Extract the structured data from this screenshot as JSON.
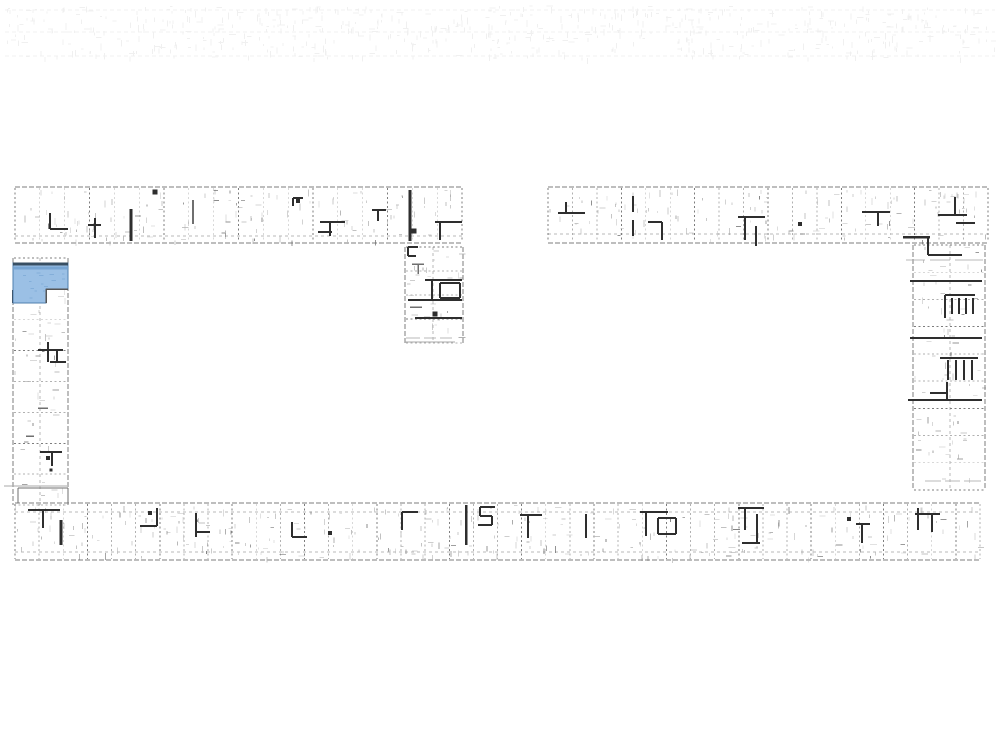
{
  "page": {
    "kind": "architectural-site-floor-plan",
    "background": "#ffffff",
    "description_visible_text": ""
  },
  "floorplan": {
    "canvas": {
      "w": 1000,
      "h": 750,
      "bg": "#ffffff"
    },
    "palette": {
      "dark": "#2e2e2e",
      "mid": "#6f6f6f",
      "light": "#a9a9a9",
      "noise": "#b6b6b6",
      "edge": "#7c7c7c",
      "ghost": "#9a9a9a",
      "highlight_fill": "#9bc0e5",
      "highlight_shade": "#74a3d2",
      "highlight_top_edge": "#384f63",
      "highlight_outline": "#4f7fae",
      "notch_edge": "#555555"
    },
    "ghost_strip": {
      "x": 5,
      "y": 6,
      "w": 990,
      "h": 52,
      "opacity": 0.14,
      "lines_y": [
        10,
        32,
        56
      ],
      "tick_count": 620
    },
    "wings": [
      {
        "id": "wing-top-left",
        "dir": "h",
        "x": 15,
        "y": 187,
        "len": 447,
        "th": 56,
        "units": 18,
        "inner": [
          236
        ]
      },
      {
        "id": "wing-top-right",
        "dir": "h",
        "x": 548,
        "y": 187,
        "len": 440,
        "th": 56,
        "units": 18,
        "inner": [
          234
        ]
      },
      {
        "id": "wing-bottom",
        "dir": "h",
        "x": 15,
        "y": 503,
        "len": 965,
        "th": 57,
        "units": 40,
        "inner": [
          512,
          552
        ]
      },
      {
        "id": "wing-left-column",
        "dir": "v",
        "x": 13,
        "y": 258,
        "len": 247,
        "th": 55,
        "units": 8,
        "inner": [
          40
        ]
      },
      {
        "id": "wing-mid-column",
        "dir": "v",
        "x": 405,
        "y": 247,
        "len": 96,
        "th": 58,
        "units": 4,
        "inner": [
          433
        ]
      },
      {
        "id": "wing-right-column",
        "dir": "v",
        "x": 913,
        "y": 245,
        "len": 245,
        "th": 72,
        "units": 9,
        "inner": [
          950
        ]
      }
    ],
    "fixtures": [
      {
        "segs": [
          [
            50,
            213,
            50,
            229
          ],
          [
            50,
            229,
            68,
            229
          ]
        ],
        "w": 2.2,
        "c": "dark"
      },
      {
        "segs": [
          [
            95,
            218,
            95,
            238
          ],
          [
            88,
            225,
            101,
            225
          ]
        ],
        "w": 1.8,
        "c": "dark"
      },
      {
        "segs": [
          [
            131,
            209,
            131,
            241
          ]
        ],
        "w": 3,
        "c": "dark"
      },
      {
        "segs": [
          [
            193,
            200,
            193,
            224
          ]
        ],
        "w": 1.8,
        "c": "mid"
      },
      {
        "segs": [
          [
            293,
            198,
            303,
            198
          ],
          [
            293,
            198,
            293,
            206
          ]
        ],
        "w": 2,
        "c": "dark"
      },
      {
        "segs": [
          [
            320,
            222,
            345,
            222
          ],
          [
            330,
            222,
            330,
            236
          ],
          [
            318,
            232,
            332,
            232
          ]
        ],
        "w": 2.2,
        "c": "dark"
      },
      {
        "segs": [
          [
            372,
            210,
            386,
            210
          ],
          [
            378,
            210,
            378,
            221
          ]
        ],
        "w": 2,
        "c": "dark"
      },
      {
        "segs": [
          [
            410,
            190,
            410,
            241
          ]
        ],
        "w": 2.8,
        "c": "dark"
      },
      {
        "segs": [
          [
            435,
            222,
            462,
            222
          ],
          [
            440,
            222,
            440,
            240
          ]
        ],
        "w": 2.2,
        "c": "dark"
      },
      {
        "segs": [
          [
            408,
            247,
            418,
            247
          ],
          [
            408,
            247,
            408,
            256
          ],
          [
            408,
            256,
            416,
            256
          ]
        ],
        "w": 2,
        "c": "dark"
      },
      {
        "segs": [
          [
            412,
            264,
            424,
            264
          ],
          [
            418,
            264,
            418,
            274
          ]
        ],
        "w": 1.5,
        "c": "mid"
      },
      {
        "segs": [
          [
            425,
            280,
            462,
            280
          ],
          [
            432,
            280,
            432,
            300
          ]
        ],
        "w": 2.2,
        "c": "dark"
      },
      {
        "segs": [
          [
            440,
            283,
            460,
            283
          ],
          [
            460,
            283,
            460,
            298
          ],
          [
            440,
            298,
            460,
            298
          ],
          [
            440,
            283,
            440,
            298
          ]
        ],
        "w": 2,
        "c": "dark"
      },
      {
        "segs": [
          [
            408,
            300,
            462,
            300
          ]
        ],
        "w": 1.8,
        "c": "dark"
      },
      {
        "segs": [
          [
            410,
            307,
            422,
            307
          ]
        ],
        "w": 1.5,
        "c": "mid"
      },
      {
        "segs": [
          [
            415,
            318,
            462,
            318
          ]
        ],
        "w": 2.2,
        "c": "dark"
      },
      {
        "segs": [
          [
            405,
            342,
            455,
            342
          ]
        ],
        "w": 1,
        "c": "light"
      },
      {
        "segs": [
          [
            38,
            350,
            63,
            350
          ],
          [
            48,
            342,
            48,
            362
          ],
          [
            57,
            351,
            57,
            362
          ],
          [
            50,
            362,
            66,
            362
          ]
        ],
        "w": 2,
        "c": "dark"
      },
      {
        "segs": [
          [
            38,
            408,
            48,
            408
          ]
        ],
        "w": 1.5,
        "c": "mid"
      },
      {
        "segs": [
          [
            26,
            436,
            34,
            436
          ]
        ],
        "w": 1.5,
        "c": "mid"
      },
      {
        "segs": [
          [
            40,
            452,
            62,
            452
          ],
          [
            52,
            452,
            52,
            466
          ]
        ],
        "w": 2,
        "c": "dark"
      },
      {
        "segs": [
          [
            4,
            486,
            67,
            486
          ]
        ],
        "w": 1,
        "c": "light"
      },
      {
        "segs": [
          [
            18,
            488,
            18,
            503
          ],
          [
            18,
            488,
            68,
            488
          ],
          [
            68,
            488,
            68,
            503
          ]
        ],
        "w": 1.2,
        "c": "mid"
      },
      {
        "segs": [
          [
            28,
            510,
            60,
            510
          ],
          [
            43,
            510,
            43,
            528
          ]
        ],
        "w": 2.2,
        "c": "dark"
      },
      {
        "segs": [
          [
            61,
            520,
            61,
            545
          ]
        ],
        "w": 3,
        "c": "dark"
      },
      {
        "segs": [
          [
            13,
            290,
            13,
            303
          ]
        ],
        "w": 2.5,
        "c": "dark"
      },
      {
        "segs": [
          [
            558,
            213,
            585,
            213
          ],
          [
            566,
            202,
            566,
            213
          ]
        ],
        "w": 2.2,
        "c": "dark"
      },
      {
        "segs": [
          [
            633,
            196,
            633,
            212
          ],
          [
            633,
            220,
            633,
            236
          ]
        ],
        "w": 1.8,
        "c": "dark"
      },
      {
        "segs": [
          [
            648,
            222,
            662,
            222
          ],
          [
            662,
            222,
            662,
            240
          ]
        ],
        "w": 2.2,
        "c": "dark"
      },
      {
        "segs": [
          [
            738,
            217,
            765,
            217
          ],
          [
            745,
            217,
            745,
            240
          ],
          [
            756,
            226,
            756,
            246
          ]
        ],
        "w": 2.2,
        "c": "dark"
      },
      {
        "segs": [
          [
            862,
            212,
            890,
            212
          ],
          [
            878,
            212,
            878,
            226
          ]
        ],
        "w": 2.2,
        "c": "dark"
      },
      {
        "segs": [
          [
            938,
            215,
            967,
            215
          ],
          [
            955,
            197,
            955,
            215
          ]
        ],
        "w": 2.2,
        "c": "dark"
      },
      {
        "segs": [
          [
            956,
            223,
            975,
            223
          ]
        ],
        "w": 1.8,
        "c": "dark"
      },
      {
        "segs": [
          [
            903,
            237,
            930,
            237
          ]
        ],
        "w": 2.5,
        "c": "dark"
      },
      {
        "segs": [
          [
            928,
            238,
            928,
            255
          ],
          [
            928,
            255,
            962,
            255
          ]
        ],
        "w": 2.2,
        "c": "dark"
      },
      {
        "segs": [
          [
            910,
            281,
            982,
            281
          ]
        ],
        "w": 2,
        "c": "dark"
      },
      {
        "segs": [
          [
            945,
            295,
            975,
            295
          ],
          [
            945,
            295,
            945,
            318
          ],
          [
            952,
            298,
            952,
            314
          ],
          [
            959,
            298,
            959,
            314
          ],
          [
            966,
            298,
            966,
            314
          ],
          [
            973,
            298,
            973,
            314
          ]
        ],
        "w": 1.7,
        "c": "dark"
      },
      {
        "segs": [
          [
            910,
            338,
            982,
            338
          ]
        ],
        "w": 2,
        "c": "dark"
      },
      {
        "segs": [
          [
            940,
            358,
            978,
            358
          ],
          [
            948,
            360,
            948,
            380
          ],
          [
            956,
            360,
            956,
            380
          ],
          [
            964,
            360,
            964,
            380
          ],
          [
            972,
            360,
            972,
            380
          ]
        ],
        "w": 1.7,
        "c": "dark"
      },
      {
        "segs": [
          [
            947,
            382,
            947,
            400
          ],
          [
            930,
            393,
            947,
            393
          ]
        ],
        "w": 2.2,
        "c": "dark"
      },
      {
        "segs": [
          [
            908,
            400,
            982,
            400
          ]
        ],
        "w": 2.2,
        "c": "dark"
      },
      {
        "segs": [
          [
            157,
            508,
            157,
            526
          ],
          [
            140,
            526,
            157,
            526
          ]
        ],
        "w": 2.2,
        "c": "dark"
      },
      {
        "segs": [
          [
            196,
            513,
            196,
            537
          ],
          [
            196,
            532,
            210,
            532
          ]
        ],
        "w": 2,
        "c": "dark"
      },
      {
        "segs": [
          [
            292,
            522,
            292,
            537
          ],
          [
            292,
            537,
            307,
            537
          ]
        ],
        "w": 2,
        "c": "dark"
      },
      {
        "segs": [
          [
            402,
            512,
            418,
            512
          ],
          [
            402,
            512,
            402,
            530
          ]
        ],
        "w": 2.2,
        "c": "dark"
      },
      {
        "segs": [
          [
            466,
            505,
            466,
            545
          ]
        ],
        "w": 2.5,
        "c": "dark"
      },
      {
        "segs": [
          [
            480,
            507,
            495,
            507
          ],
          [
            480,
            507,
            480,
            516
          ],
          [
            480,
            516,
            492,
            516
          ],
          [
            492,
            516,
            492,
            525
          ],
          [
            478,
            525,
            492,
            525
          ]
        ],
        "w": 1.7,
        "c": "dark"
      },
      {
        "segs": [
          [
            520,
            515,
            542,
            515
          ],
          [
            528,
            515,
            528,
            538
          ]
        ],
        "w": 2.2,
        "c": "dark"
      },
      {
        "segs": [
          [
            586,
            514,
            586,
            538
          ]
        ],
        "w": 2.2,
        "c": "dark"
      },
      {
        "segs": [
          [
            640,
            512,
            668,
            512
          ],
          [
            646,
            512,
            646,
            536
          ]
        ],
        "w": 2,
        "c": "dark"
      },
      {
        "segs": [
          [
            658,
            518,
            676,
            518
          ],
          [
            676,
            518,
            676,
            534
          ],
          [
            658,
            534,
            676,
            534
          ],
          [
            658,
            518,
            658,
            534
          ]
        ],
        "w": 1.8,
        "c": "dark"
      },
      {
        "segs": [
          [
            738,
            508,
            764,
            508
          ],
          [
            745,
            508,
            745,
            530
          ],
          [
            757,
            514,
            757,
            543
          ],
          [
            742,
            543,
            760,
            543
          ]
        ],
        "w": 2,
        "c": "dark"
      },
      {
        "segs": [
          [
            856,
            524,
            870,
            524
          ],
          [
            862,
            524,
            862,
            543
          ]
        ],
        "w": 2,
        "c": "dark"
      },
      {
        "segs": [
          [
            918,
            508,
            918,
            530
          ],
          [
            915,
            514,
            940,
            514
          ],
          [
            932,
            514,
            932,
            532
          ]
        ],
        "w": 2,
        "c": "dark"
      }
    ],
    "dots": [
      {
        "x": 155,
        "y": 192,
        "s": 5
      },
      {
        "x": 298,
        "y": 201,
        "s": 4
      },
      {
        "x": 414,
        "y": 231,
        "s": 5
      },
      {
        "x": 435,
        "y": 314,
        "s": 5
      },
      {
        "x": 800,
        "y": 224,
        "s": 4
      },
      {
        "x": 48,
        "y": 458,
        "s": 4
      },
      {
        "x": 51,
        "y": 470,
        "s": 3
      },
      {
        "x": 150,
        "y": 513,
        "s": 4
      },
      {
        "x": 330,
        "y": 533,
        "s": 4
      },
      {
        "x": 849,
        "y": 519,
        "s": 4
      }
    ],
    "micro_marks": [
      [
        406,
        338,
        420,
        338
      ],
      [
        424,
        338,
        436,
        338
      ],
      [
        440,
        338,
        452,
        338
      ],
      [
        906,
        260,
        925,
        260
      ],
      [
        930,
        260,
        950,
        260
      ],
      [
        955,
        260,
        983,
        260
      ],
      [
        925,
        481,
        941,
        481
      ],
      [
        945,
        481,
        960,
        481
      ],
      [
        964,
        481,
        981,
        481
      ]
    ],
    "highlight_unit": {
      "points": "13,263 68,263 68,289 46,289 46,303 13,303",
      "notch": [
        [
          46,
          289,
          68,
          289
        ],
        [
          46,
          289,
          46,
          303
        ]
      ],
      "top_edge": [
        13,
        264,
        68,
        264
      ],
      "inner_shade": [
        14,
        268,
        67,
        268
      ]
    },
    "noise": {
      "seed": 1337,
      "per_unit": 7
    }
  }
}
